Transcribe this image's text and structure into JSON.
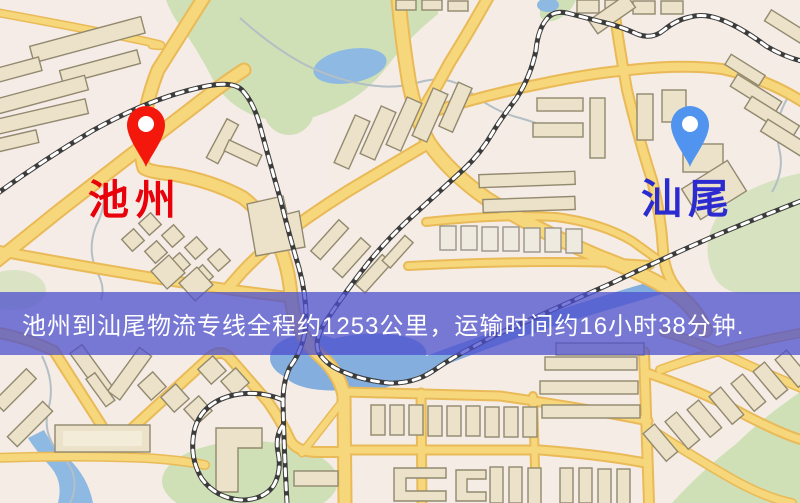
{
  "map": {
    "origin": {
      "name": "池州",
      "pin_color": "#f3170c",
      "label_color": "#e8000a"
    },
    "destination": {
      "name": "汕尾",
      "pin_color": "#5094ef",
      "label_color": "#2b2bd0"
    },
    "route": {
      "distance_km": "1253",
      "duration_hours": "16",
      "duration_minutes": "38"
    },
    "banner": {
      "text": "池州到汕尾物流专线全程约1253公里，运输时间约16小时38分钟.",
      "background": "rgba(76,78,206,0.74)",
      "text_color": "#ffffff"
    },
    "icons": [
      "origin-pin-icon",
      "destination-pin-icon"
    ],
    "colors": {
      "background": "#f4ece5",
      "road_fill": "#f7d77b",
      "road_casing": "#e9ba57",
      "park": "#cfe0b6",
      "water": "#8db9e2",
      "building": "#ebe2c9",
      "building_outline": "#92896f",
      "railway": "#3c3c3c",
      "railway_dash": "#ffffff"
    }
  }
}
